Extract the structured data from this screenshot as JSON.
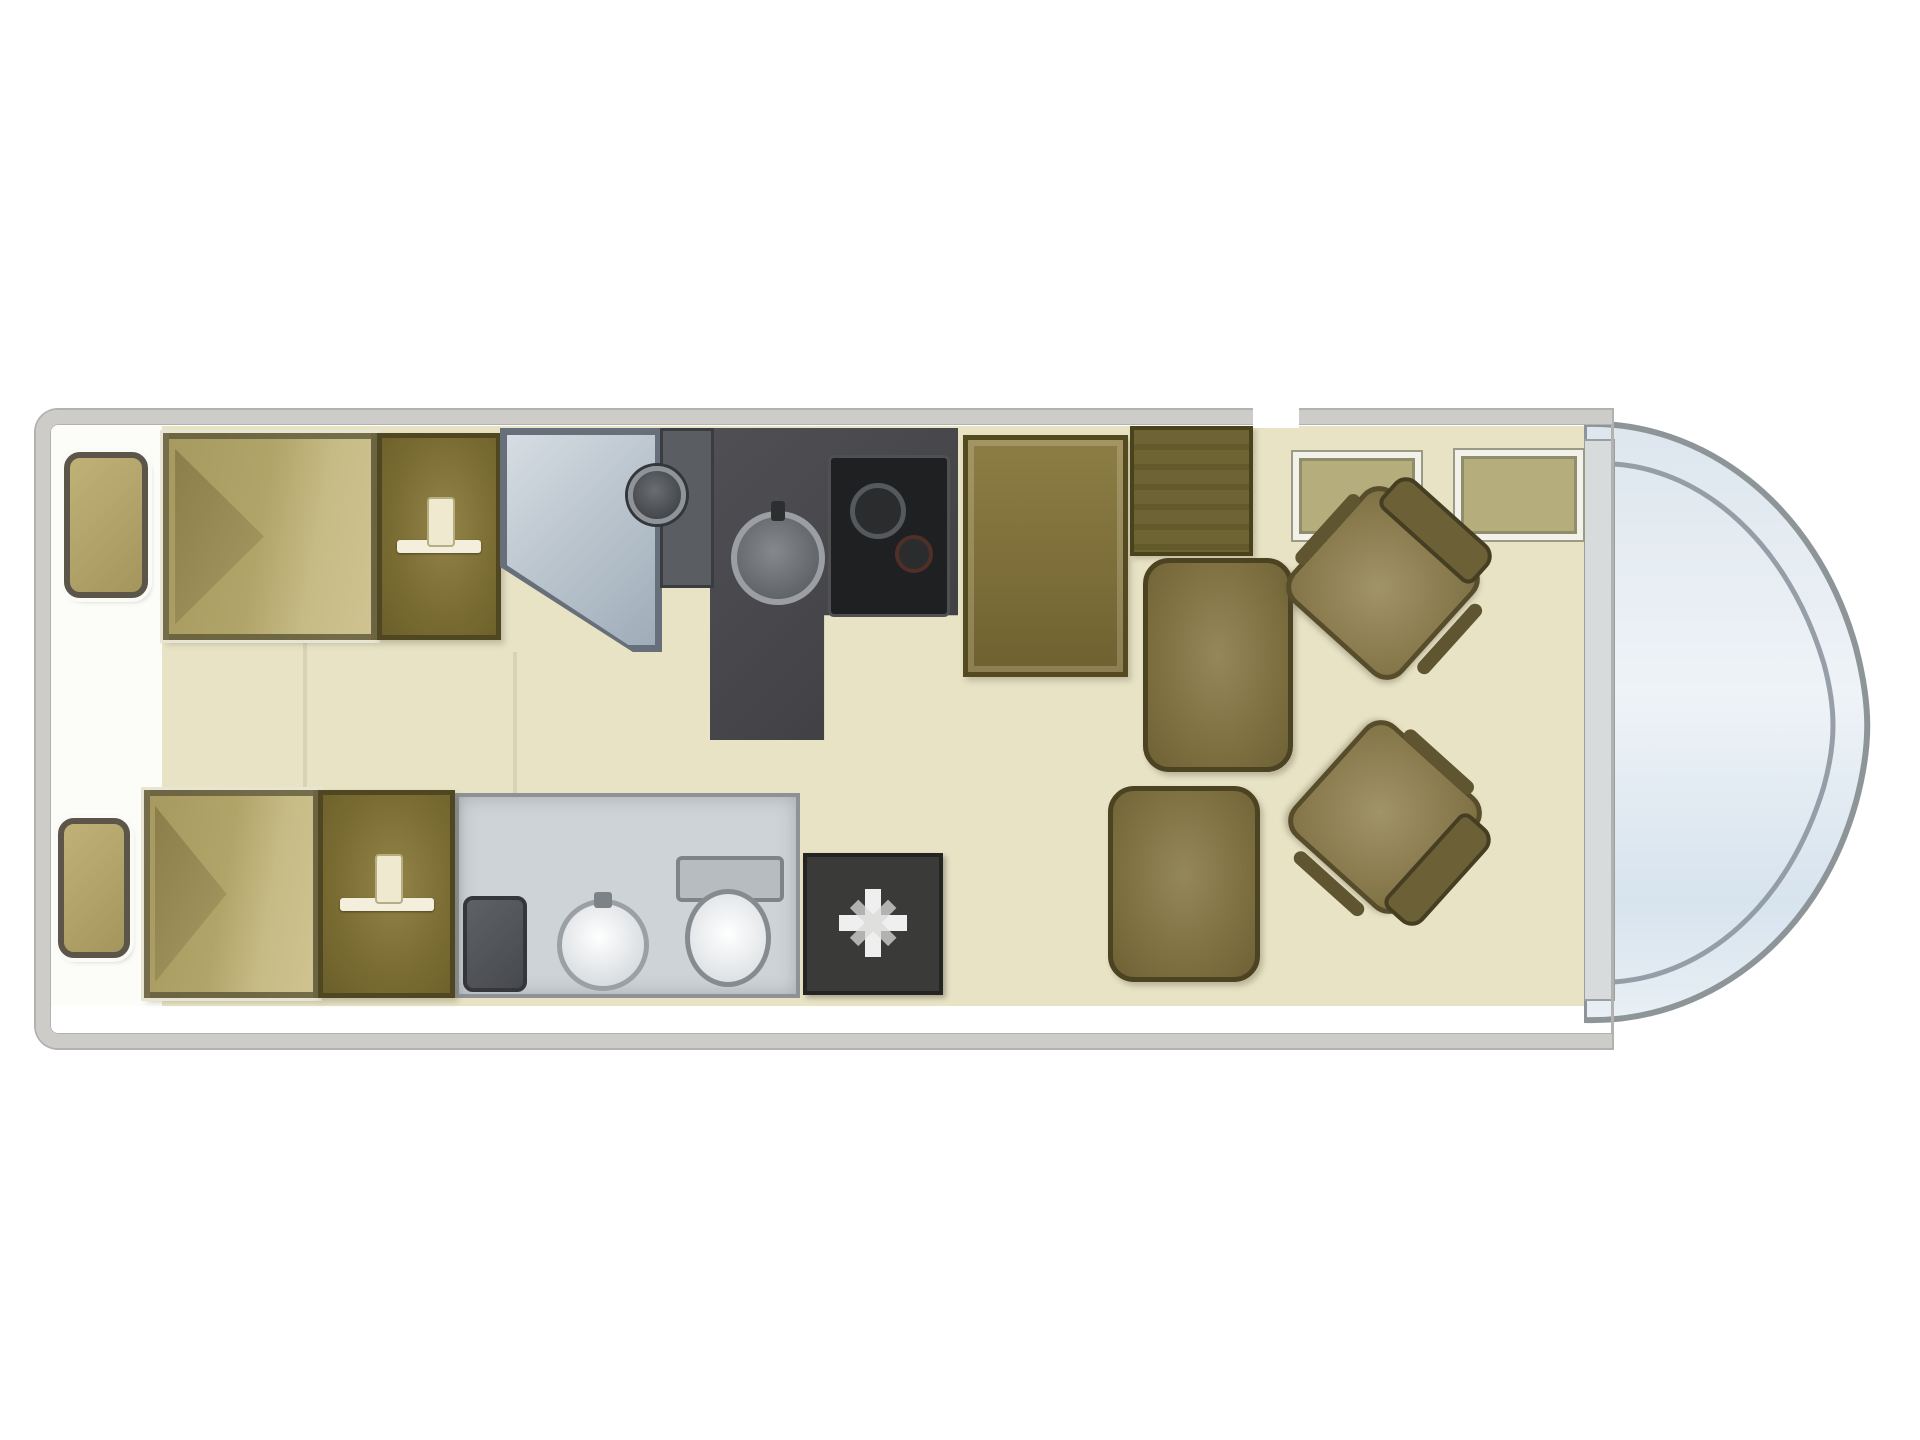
{
  "diagram": {
    "kind": "motorhome-floorplan",
    "view": "top-down",
    "palette": {
      "background": "#ffffff",
      "floor": "#e9e3c6",
      "wall_gray": "#cdccc8",
      "furniture_olive": "#7b6d33",
      "upholstery_brown": "#7e7040",
      "kitchen_dark": "#47474b",
      "shower_blue_gray": "#bcc6cf",
      "bathroom_gray": "#ced3d7",
      "windshield_blue": "#d7e3ee",
      "heater_dark": "#3a3a38",
      "bed_tan": "#b1a469",
      "accent_white": "#f2f1ea"
    },
    "zones": [
      {
        "label": "rear-twin-bedroom"
      },
      {
        "label": "shower-and-washroom"
      },
      {
        "label": "kitchen"
      },
      {
        "label": "front-lounge"
      },
      {
        "label": "driver-cab"
      }
    ]
  },
  "elements": [
    {
      "name": "nightstand-rear-top",
      "kind": "nightstand",
      "x": 64,
      "y": 452,
      "w": 84,
      "h": 146
    },
    {
      "name": "single-bed-top",
      "kind": "bed",
      "x": 163,
      "y": 433,
      "w": 214,
      "h": 207
    },
    {
      "name": "wardrobe-top",
      "kind": "wardrobe",
      "x": 377,
      "y": 433,
      "w": 124,
      "h": 207
    },
    {
      "name": "shower-cubicle",
      "kind": "shower",
      "x": 500,
      "y": 428,
      "w": 162,
      "h": 224
    },
    {
      "name": "vanity-strip",
      "kind": "vanity",
      "x": 660,
      "y": 428,
      "w": 54,
      "h": 160
    },
    {
      "name": "corner-washbasin",
      "kind": "round-basin-dark",
      "x": 628,
      "y": 466,
      "w": 58,
      "h": 58
    },
    {
      "name": "kitchen-unit",
      "kind": "kitchen",
      "x": 710,
      "y": 428,
      "w": 248,
      "h": 312
    },
    {
      "name": "kitchen-sink",
      "kind": "sink",
      "x": 731,
      "y": 511,
      "w": 94,
      "h": 94
    },
    {
      "name": "kitchen-hob",
      "kind": "hob",
      "x": 828,
      "y": 455,
      "w": 122,
      "h": 162
    },
    {
      "name": "fridge-tall-cabinet",
      "kind": "tall-cabinet",
      "x": 963,
      "y": 435,
      "w": 165,
      "h": 242
    },
    {
      "name": "side-cabinet",
      "kind": "side-cabinet",
      "x": 1130,
      "y": 426,
      "w": 123,
      "h": 130
    },
    {
      "name": "lounge-seat-front",
      "kind": "lounge-chair",
      "x": 1143,
      "y": 558,
      "w": 150,
      "h": 214
    },
    {
      "name": "lounge-seat-rear",
      "kind": "lounge-chair",
      "x": 1108,
      "y": 786,
      "w": 152,
      "h": 196
    },
    {
      "name": "front-shelf-left",
      "kind": "shelf",
      "x": 1293,
      "y": 452,
      "w": 128,
      "h": 88
    },
    {
      "name": "front-shelf-right",
      "kind": "shelf",
      "x": 1455,
      "y": 450,
      "w": 128,
      "h": 90
    },
    {
      "name": "swivel-cab-seat-top",
      "kind": "seat",
      "x": 1308,
      "y": 508,
      "w": 150,
      "h": 150,
      "rot": 42
    },
    {
      "name": "swivel-cab-seat-bottom",
      "kind": "seat",
      "x": 1310,
      "y": 742,
      "w": 150,
      "h": 150,
      "rot": 132
    },
    {
      "name": "washroom",
      "kind": "washroom",
      "x": 455,
      "y": 793,
      "w": 345,
      "h": 205
    },
    {
      "name": "washroom-utility-box",
      "kind": "utility",
      "x": 463,
      "y": 896,
      "w": 64,
      "h": 96
    },
    {
      "name": "washroom-basin",
      "kind": "basin",
      "x": 557,
      "y": 899,
      "w": 92,
      "h": 92
    },
    {
      "name": "toilet",
      "kind": "toilet",
      "x": 676,
      "y": 856,
      "w": 108,
      "h": 136
    },
    {
      "name": "heater-unit",
      "kind": "heater",
      "x": 803,
      "y": 853,
      "w": 140,
      "h": 142,
      "children": [
        {
          "name": "heater-fan-icon",
          "kind": "fan-icon",
          "x": 32,
          "y": 32,
          "w": 68,
          "h": 68
        }
      ]
    },
    {
      "name": "nightstand-rear-bottom",
      "kind": "nightstand",
      "x": 58,
      "y": 818,
      "w": 72,
      "h": 140
    },
    {
      "name": "single-bed-bottom",
      "kind": "bed",
      "x": 144,
      "y": 790,
      "w": 175,
      "h": 208
    },
    {
      "name": "wardrobe-bottom",
      "kind": "wardrobe",
      "x": 318,
      "y": 790,
      "w": 137,
      "h": 208
    },
    {
      "name": "corridor-divider-1",
      "kind": "divider",
      "x": 303,
      "y": 642,
      "w": 4,
      "h": 148
    },
    {
      "name": "corridor-divider-2",
      "kind": "divider",
      "x": 513,
      "y": 652,
      "w": 4,
      "h": 141
    }
  ]
}
